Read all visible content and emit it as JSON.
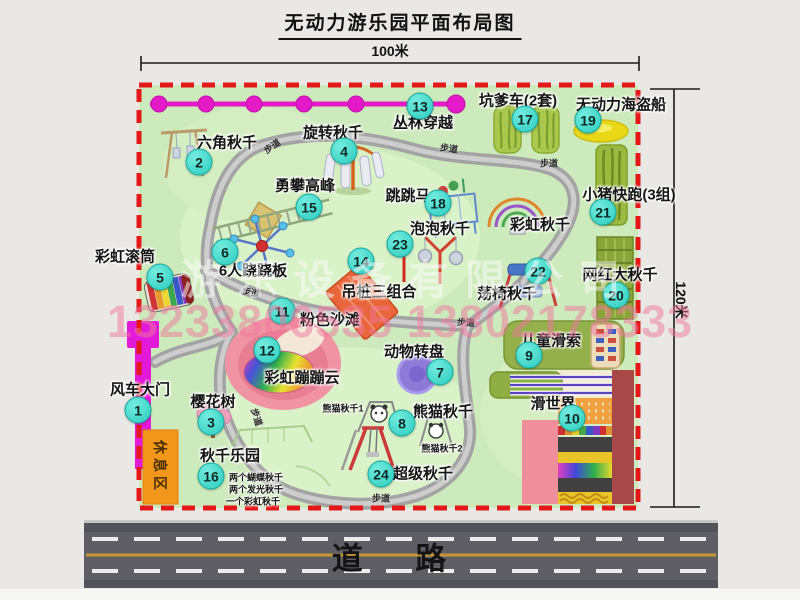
{
  "title": "无动力游乐园平面布局图",
  "dimensions": {
    "width_label": "100米",
    "height_label": "120米"
  },
  "road_label": "道 路",
  "rest_area_label": "休息区",
  "watermark": {
    "company": "游乐设备有限公司",
    "phone": "13233806535 13802178333"
  },
  "colors": {
    "map_green": "#cdeabc",
    "border_red": "#e41818",
    "badge_cyan": "#2fd6c8",
    "gate_magenta": "#e21ad8",
    "zipline_magenta": "#e41ac8",
    "rest_orange": "#f2971c",
    "road_gray": "#5e5e64",
    "path_gray": "#a3a3a3"
  },
  "attractions": [
    {
      "num": "1",
      "label": "风车大门",
      "bx": 138,
      "by": 410,
      "lx": 140,
      "ly": 389
    },
    {
      "num": "2",
      "label": "六角秋千",
      "bx": 199,
      "by": 162,
      "lx": 227,
      "ly": 142
    },
    {
      "num": "3",
      "label": "樱花树",
      "bx": 211,
      "by": 422,
      "lx": 213,
      "ly": 401
    },
    {
      "num": "4",
      "label": "旋转秋千",
      "bx": 344,
      "by": 151,
      "lx": 333,
      "ly": 132
    },
    {
      "num": "5",
      "label": "彩虹滚筒",
      "bx": 160,
      "by": 277,
      "lx": 125,
      "ly": 256
    },
    {
      "num": "6",
      "label": "6人跷跷板",
      "bx": 225,
      "by": 252,
      "lx": 253,
      "ly": 270
    },
    {
      "num": "7",
      "label": "动物转盘",
      "bx": 440,
      "by": 372,
      "lx": 414,
      "ly": 351
    },
    {
      "num": "8",
      "label": "熊猫秋千",
      "bx": 402,
      "by": 423,
      "lx": 443,
      "ly": 411
    },
    {
      "num": "9",
      "label": "儿童滑索",
      "bx": 529,
      "by": 355,
      "lx": 551,
      "ly": 340
    },
    {
      "num": "10",
      "label": "滑世界",
      "bx": 572,
      "by": 418,
      "lx": 553,
      "ly": 403
    },
    {
      "num": "11",
      "label": "粉色沙滩",
      "bx": 282,
      "by": 311,
      "lx": 330,
      "ly": 319
    },
    {
      "num": "12",
      "label": "彩虹蹦蹦云",
      "bx": 267,
      "by": 350,
      "lx": 302,
      "ly": 377
    },
    {
      "num": "13",
      "label": "丛林穿越",
      "bx": 420,
      "by": 106,
      "lx": 423,
      "ly": 122
    },
    {
      "num": "14",
      "label": "吊桩三组合",
      "bx": 361,
      "by": 261,
      "lx": 379,
      "ly": 291
    },
    {
      "num": "15",
      "label": "勇攀高峰",
      "bx": 309,
      "by": 207,
      "lx": 305,
      "ly": 185
    },
    {
      "num": "16",
      "label": "秋千乐园",
      "bx": 211,
      "by": 476,
      "lx": 230,
      "ly": 455
    },
    {
      "num": "17",
      "label": "坑爹车(2套)",
      "bx": 525,
      "by": 119,
      "lx": 518,
      "ly": 100
    },
    {
      "num": "18",
      "label": "跳跳马",
      "bx": 438,
      "by": 203,
      "lx": 408,
      "ly": 195
    },
    {
      "num": "19",
      "label": "无动力海盗船",
      "bx": 588,
      "by": 120,
      "lx": 621,
      "ly": 104
    },
    {
      "num": "20",
      "label": "网红大秋千",
      "bx": 616,
      "by": 295,
      "lx": 620,
      "ly": 274
    },
    {
      "num": "21",
      "label": "小猪快跑(3组)",
      "bx": 603,
      "by": 212,
      "lx": 629,
      "ly": 194
    },
    {
      "num": "22",
      "label": "荡椅秋千",
      "bx": 538,
      "by": 271,
      "lx": 507,
      "ly": 293
    },
    {
      "num": "23",
      "label": "泡泡秋千",
      "bx": 400,
      "by": 244,
      "lx": 440,
      "ly": 228
    },
    {
      "num": "24",
      "label": "超级秋千",
      "bx": 381,
      "by": 474,
      "lx": 423,
      "ly": 473
    }
  ],
  "extra_labels": [
    {
      "text": "彩虹秋千",
      "x": 540,
      "y": 224,
      "size": 15
    },
    {
      "text": "熊猫秋千1",
      "x": 343,
      "y": 408,
      "size": 9
    },
    {
      "text": "熊猫秋千2",
      "x": 442,
      "y": 448,
      "size": 9
    },
    {
      "text": "两个蝴蝶秋千",
      "x": 256,
      "y": 477,
      "size": 9
    },
    {
      "text": "两个发光秋千",
      "x": 256,
      "y": 489,
      "size": 9
    },
    {
      "text": "一个彩虹秋千",
      "x": 253,
      "y": 501,
      "size": 9
    }
  ],
  "path_signs": [
    {
      "text": "步道",
      "x": 272,
      "y": 146,
      "rot": -35
    },
    {
      "text": "步道",
      "x": 449,
      "y": 148,
      "rot": 8
    },
    {
      "text": "步道",
      "x": 549,
      "y": 163,
      "rot": 0
    },
    {
      "text": "步道",
      "x": 251,
      "y": 292,
      "rot": 12
    },
    {
      "text": "步道",
      "x": 466,
      "y": 322,
      "rot": 5
    },
    {
      "text": "步道",
      "x": 257,
      "y": 417,
      "rot": 72
    },
    {
      "text": "步道",
      "x": 381,
      "y": 498,
      "rot": 0
    }
  ]
}
